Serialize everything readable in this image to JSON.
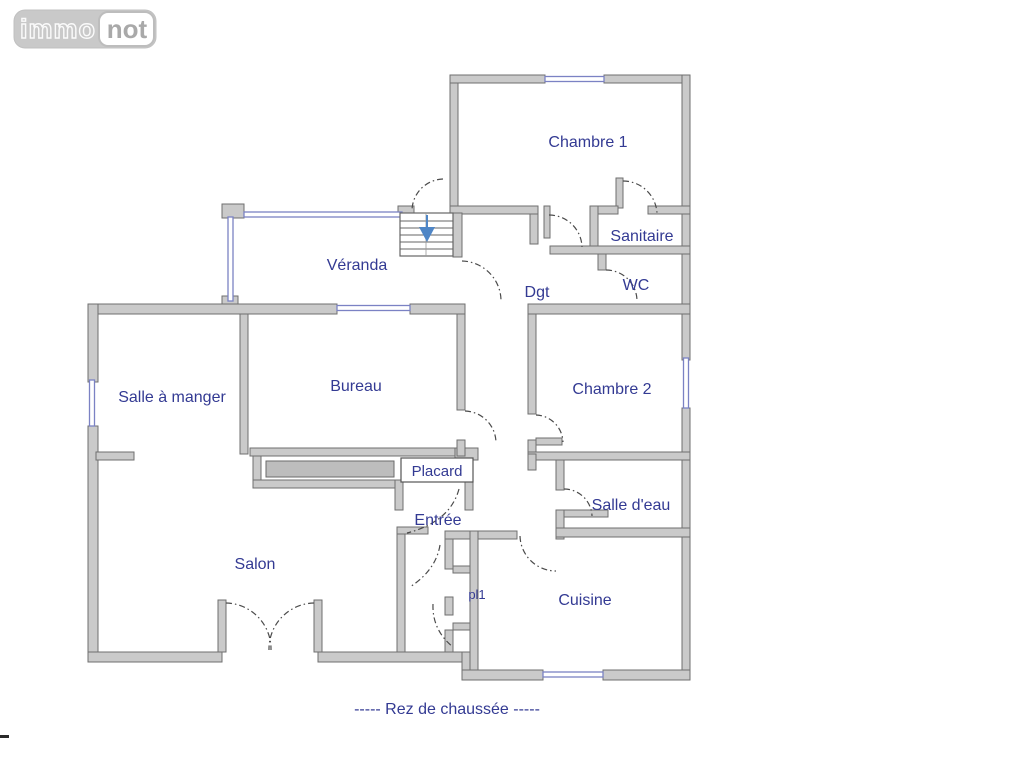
{
  "logo": {
    "immo": "immo",
    "not": "not"
  },
  "rooms": {
    "chambre1": "Chambre 1",
    "sanitaire": "Sanitaire",
    "wc": "WC",
    "dgt": "Dgt",
    "veranda": "Véranda",
    "salle_a_manger": "Salle à manger",
    "bureau": "Bureau",
    "chambre2": "Chambre 2",
    "placard": "Placard",
    "entree": "Entrée",
    "salle_deau": "Salle d'eau",
    "salon": "Salon",
    "pl1": "pl1",
    "cuisine": "Cuisine"
  },
  "caption": "----- Rez de chaussée -----",
  "colors": {
    "wall-fill": "#cacaca",
    "wall-stroke": "#6f6f6f",
    "window": "#7b82c4",
    "label": "#333a93",
    "door": "#4a4a4a",
    "stairs-arrow": "#4f86c6",
    "logo-gray": "#c9c9c9",
    "logo-text": "#a9a9a9"
  }
}
